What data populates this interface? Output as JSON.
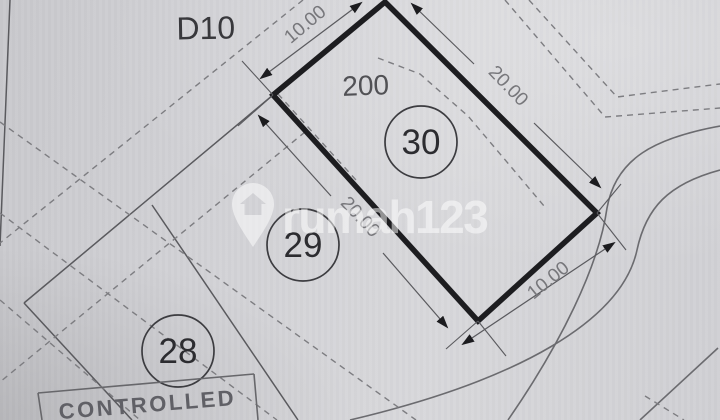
{
  "block_label": "D10",
  "lots": {
    "lot30": {
      "number": "30",
      "area": "200",
      "dimensions": {
        "width_top": "10.00",
        "length_right": "20.00",
        "length_left": "20.00",
        "width_bottom": "10.00"
      }
    },
    "lot29": {
      "number": "29"
    },
    "lot28": {
      "number": "28"
    }
  },
  "stamp": {
    "text": "CONTROLLED"
  },
  "watermark": {
    "brand": "rumah123",
    "icon": "house-pin-icon"
  },
  "colors": {
    "paper": "#d2d2d6",
    "boundary_thick": "#1d1d20",
    "line_thin": "#5a5a5e",
    "dashed_line": "#7d7d81",
    "label_dark": "#38383c",
    "dimension_text": "#77777b",
    "watermark_white": "rgba(255,255,255,0.52)"
  }
}
